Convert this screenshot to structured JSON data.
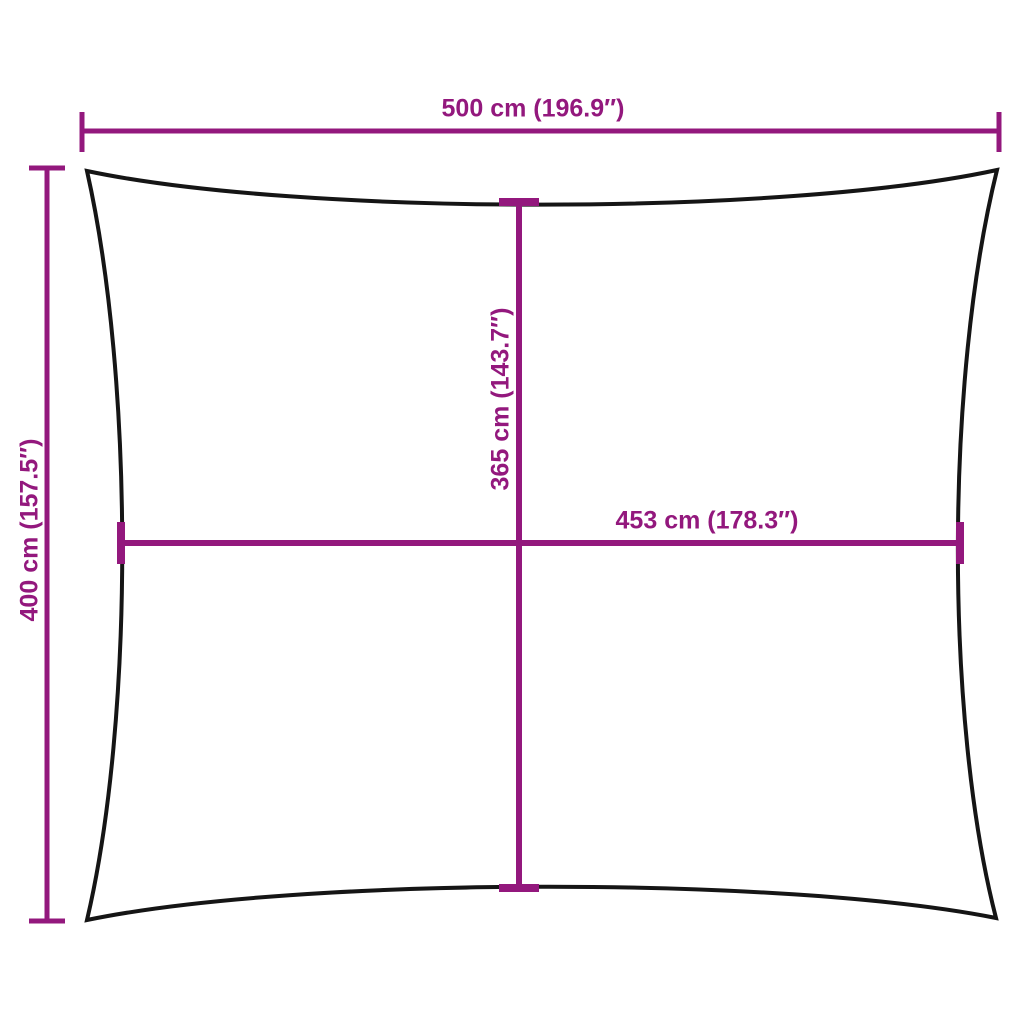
{
  "diagram": {
    "title": "rectangular-shade-sail-dimension-diagram",
    "labels": {
      "overall_width": "500 cm (196.9″)",
      "overall_height": "400 cm (157.5″)",
      "center_height": "365 cm (143.7″)",
      "center_width": "453 cm (178.3″)"
    }
  },
  "colors": {
    "dimension_accent": "#93187D",
    "outline": "#151515",
    "background": "#FFFFFF"
  }
}
